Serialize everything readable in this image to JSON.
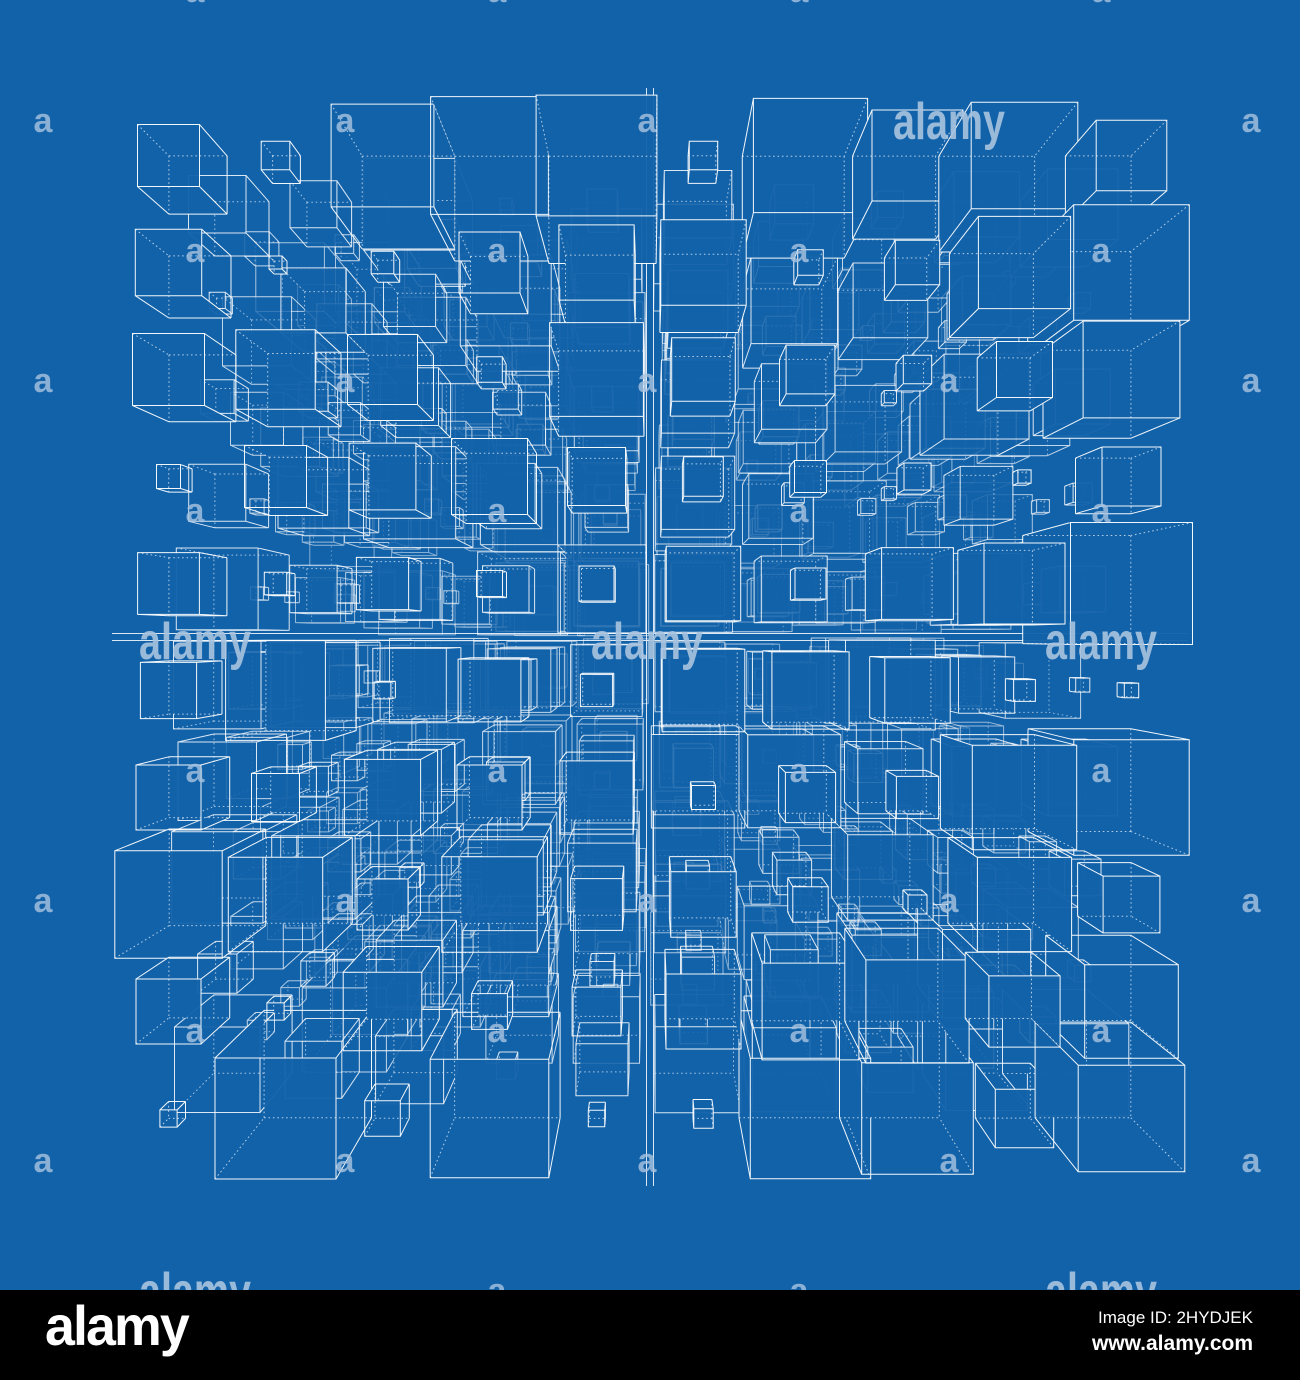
{
  "canvas": {
    "width": 1300,
    "height": 1380
  },
  "colors": {
    "background": "#1262AA",
    "line": "#FFFFFF",
    "watermark": "#A9C4E0",
    "footer_bar": "#000000",
    "footer_text": "#FFFFFF"
  },
  "artwork": {
    "type": "wireframe-cube-lattice-blueprint",
    "grid": {
      "cols": 10,
      "rows": 10,
      "layers": 6,
      "cell": 107
    },
    "vanishing_point": {
      "x": 650,
      "y": 637
    },
    "focal": 950,
    "seed": 11,
    "layer_opacity": [
      0.95,
      0.85,
      0.74,
      0.64,
      0.55,
      0.48
    ],
    "cross_axis": {
      "x_top": 88,
      "x_bottom": 1186,
      "y_left": 112,
      "y_right": 1188,
      "half_gap": 3.5
    },
    "bounds": {
      "left": 105,
      "right": 1195,
      "top": 88,
      "bottom": 1186
    }
  },
  "watermark": {
    "letter": "a",
    "word": "alamy",
    "letter_font_size": 34,
    "word_font_size": 52,
    "word_length": 112,
    "grid": {
      "row_start_y": -10,
      "row_step": 130,
      "col_step": 302,
      "col_offset_a": 43,
      "col_offset_b": 195
    },
    "words": [
      {
        "x": 949,
        "y": 120
      },
      {
        "x": 195,
        "y": 640
      },
      {
        "x": 647,
        "y": 640
      },
      {
        "x": 1101,
        "y": 640
      },
      {
        "x": 195,
        "y": 1290
      },
      {
        "x": 1101,
        "y": 1290
      }
    ]
  },
  "footer": {
    "logo": "alamy",
    "image_id": "Image ID: 2HYDJEK",
    "url": "www.alamy.com"
  }
}
